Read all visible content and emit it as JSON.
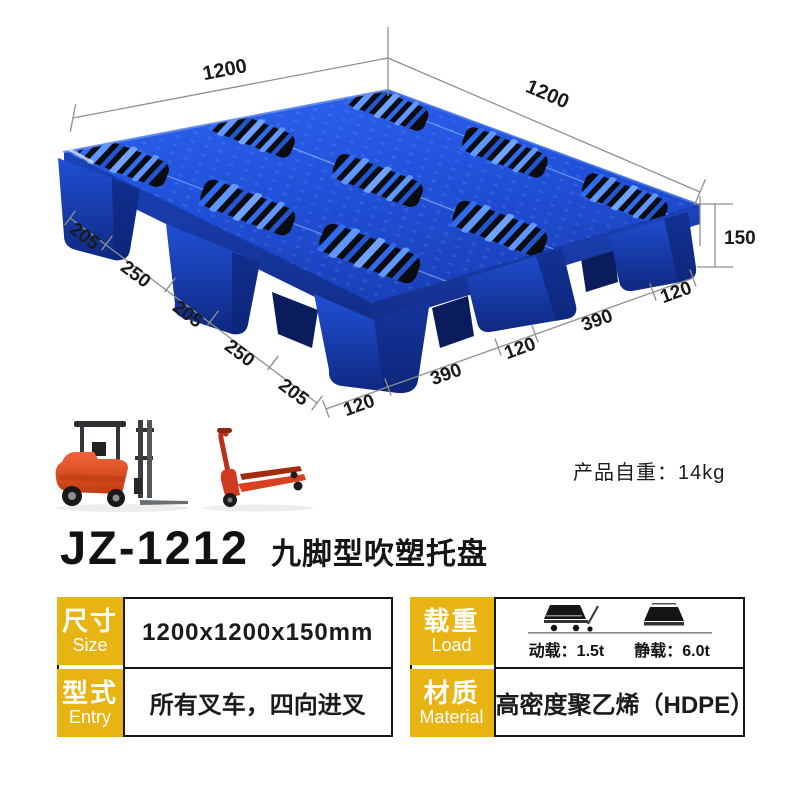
{
  "product": {
    "model": "JZ-1212",
    "series_name": "九脚型吹塑托盘",
    "weight_note": "产品自重：14kg"
  },
  "diagram": {
    "type": "dimensioned product drawing of nine-foot blow-molded plastic pallet",
    "dim_top_left": "1200",
    "dim_top_right": "1200",
    "dim_height": "150",
    "left_segments": [
      "205",
      "250",
      "205",
      "250",
      "205"
    ],
    "bottom_segments": [
      "120",
      "390",
      "120",
      "390",
      "120"
    ]
  },
  "icons": {
    "forklift": "forklift-icon",
    "pallet_jack": "pallet-jack-icon",
    "dynamic_load": "dynamic-load-icon",
    "static_load": "static-load-icon"
  },
  "specs": {
    "size": {
      "label_cn": "尺寸",
      "label_en": "Size",
      "value": "1200x1200x150mm"
    },
    "entry": {
      "label_cn": "型式",
      "label_en": "Entry",
      "value": "所有叉车，四向进叉"
    },
    "load": {
      "label_cn": "载重",
      "label_en": "Load",
      "dynamic": "动载：1.5t",
      "static": "静载：6.0t"
    },
    "material": {
      "label_cn": "材质",
      "label_en": "Material",
      "value": "高密度聚乙烯（HDPE）"
    }
  },
  "colors": {
    "accent_yellow": "#E7B414",
    "pallet_blue": "#1E4FD8",
    "table_border": "#161616",
    "forklift_orange": "#E8522A",
    "pallet_jack_red": "#D13A1F"
  }
}
